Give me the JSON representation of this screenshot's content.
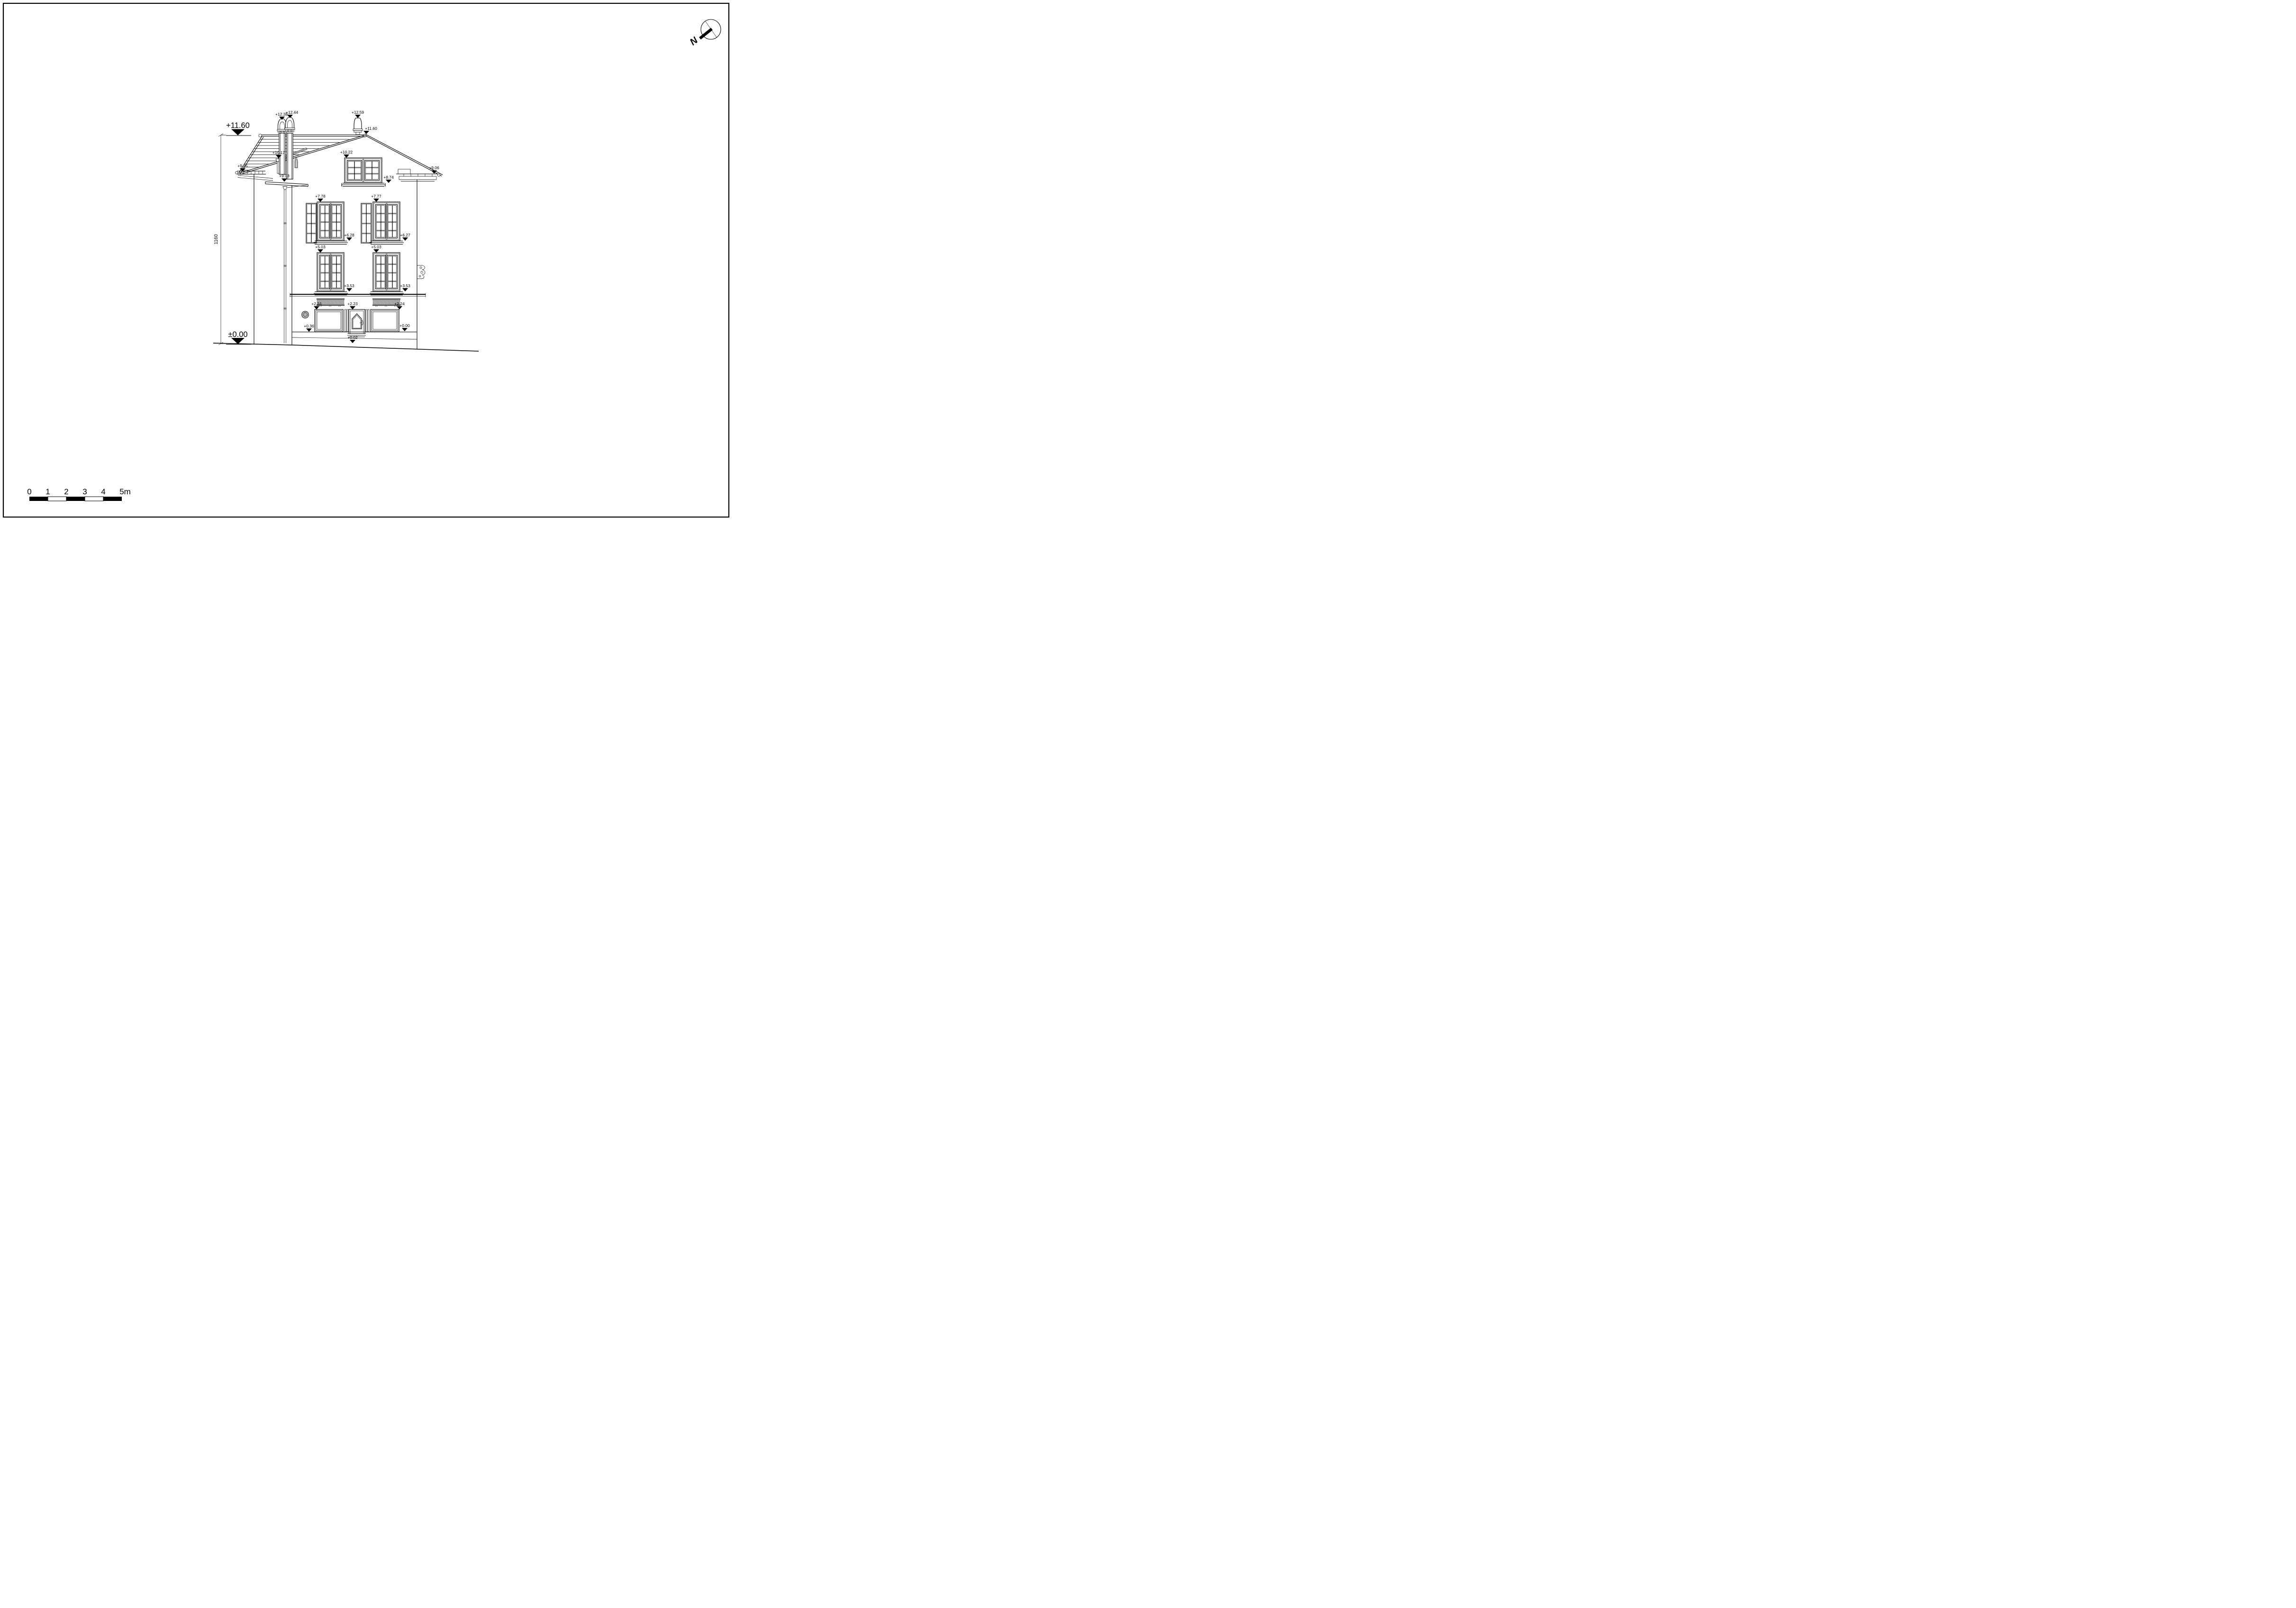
{
  "compass": {
    "north_label": "N"
  },
  "dimension": {
    "overall_height": "1160",
    "top_label": "+11.60",
    "bottom_label": "±0.00"
  },
  "levels": {
    "chimney_left": "+12.38",
    "chimney_right": "+12.44",
    "ridge_finial": "+12.59",
    "ridge_small": "+11.60",
    "roof_vent": "+10.17",
    "attic_window_top": "+10.22",
    "eaves_left_upper": "+9.35",
    "eaves_left_lower": "+9.03",
    "eaves_right": "+9.06",
    "attic_window_sill": "+8.74",
    "floor2_left_top": "+7.78",
    "floor2_right_top": "+7.77",
    "floor2_left_sill": "+6.28",
    "floor2_right_sill": "+6.27",
    "floor1_left_top": "+5.03",
    "floor1_right_top": "+5.03",
    "floor1_left_sill": "+3.53",
    "floor1_right_sill": "+3.53",
    "shop_left_top": "+2.24",
    "door_top": "+2.23",
    "shop_right_top": "+2.24",
    "shop_left_sill": "+0.36",
    "door_threshold": "+0.02",
    "ground_right": "+0.00"
  },
  "scale_bar": {
    "labels": [
      "0",
      "1",
      "2",
      "3",
      "4",
      "5m"
    ]
  }
}
